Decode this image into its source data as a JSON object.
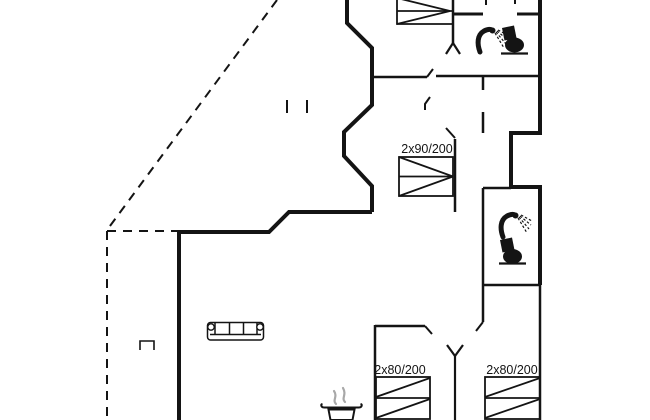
{
  "floorplan": {
    "type": "holiday-house-floor-plan",
    "background_color": "#ffffff",
    "line_color": "#141414",
    "steam_color": "#a8a8a8",
    "bed_labels": {
      "double_bed_middle": "2x90/200",
      "bed_bottom_left": "2x80/200",
      "bed_bottom_right": "2x80/200"
    },
    "icons": [
      "shower-icon",
      "toilet-icon",
      "sofa-icon",
      "steaming-pot-icon"
    ],
    "features": {
      "terrace_outline_style": "dashed",
      "bathrooms": 2,
      "beds_visible": 4
    }
  }
}
